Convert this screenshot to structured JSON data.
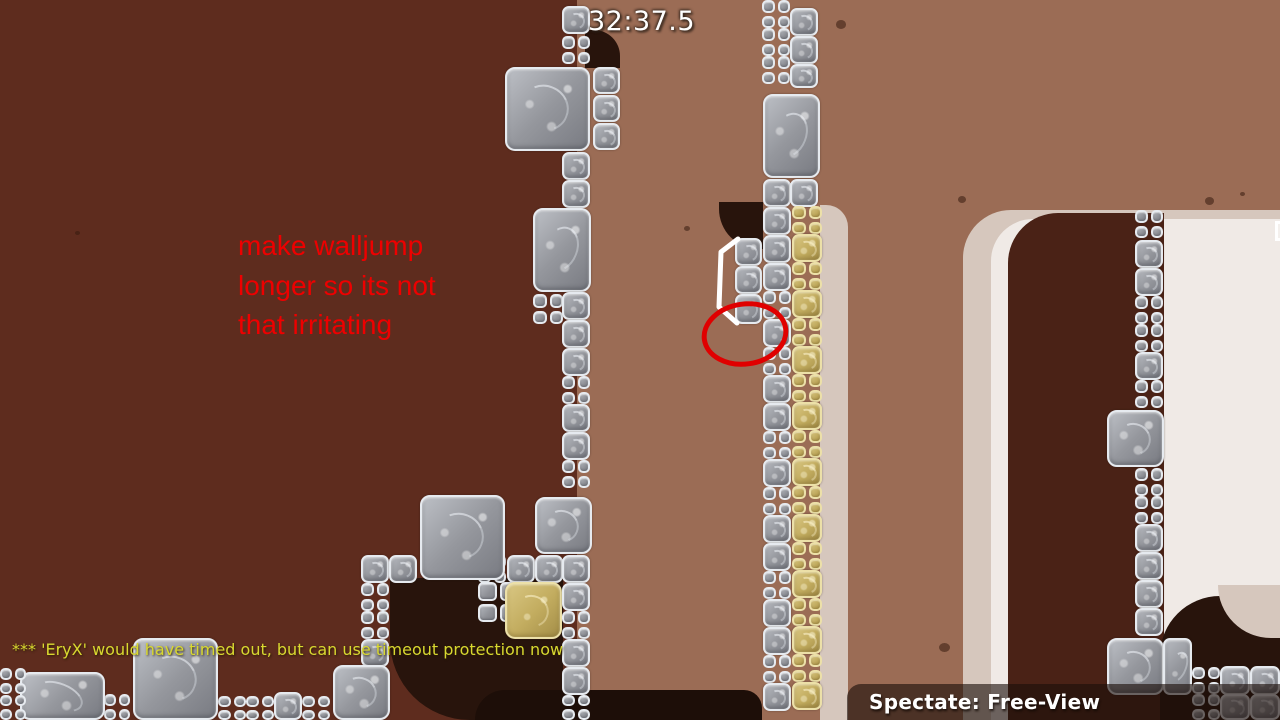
{
  "hud": {
    "timer": "32:37.5",
    "console_message": "*** 'EryX' would have timed out, but can use timeout protection now",
    "spectate_label": "Spectate: Free-View"
  },
  "annotations": {
    "note_lines": [
      "make walljump",
      "longer so its not",
      "that irritating"
    ],
    "circle": {
      "cx": 745,
      "cy": 334,
      "rx": 41,
      "ry": 30,
      "stroke_width": 5
    },
    "path_points": "738,239 721,252 719,307 737,323"
  },
  "colors": {
    "bg_mid": "#9b6c55",
    "bg_left": "#5e2c1e",
    "cave": "#28140c",
    "beige": "#d6c7bd",
    "cream": "#f0eae6",
    "inner_maroon": "#4a2216",
    "tg_border": "#e6eaef",
    "td_border": "#ece0a8",
    "note": "#ee0000",
    "console": "#d8d830",
    "hud_text": "#ffffff",
    "panel": "rgba(28,14,9,0.62)"
  },
  "map": {
    "tiles": [
      [
        "m",
        "g",
        562,
        6,
        28,
        28
      ],
      [
        "q",
        "g",
        562,
        36,
        28,
        28
      ],
      [
        "b",
        "g",
        505,
        67,
        85,
        84
      ],
      [
        "m",
        "g",
        593,
        67,
        27,
        27
      ],
      [
        "m",
        "g",
        593,
        95,
        27,
        27
      ],
      [
        "m",
        "g",
        593,
        123,
        27,
        27
      ],
      [
        "m",
        "g",
        562,
        152,
        28,
        28
      ],
      [
        "m",
        "g",
        562,
        180,
        28,
        28
      ],
      [
        "b",
        "g",
        533,
        208,
        58,
        84
      ],
      [
        "q",
        "g",
        533,
        294,
        30,
        30
      ],
      [
        "m",
        "g",
        562,
        292,
        28,
        28
      ],
      [
        "m",
        "g",
        562,
        320,
        28,
        28
      ],
      [
        "m",
        "g",
        562,
        348,
        28,
        28
      ],
      [
        "q",
        "g",
        562,
        376,
        28,
        28
      ],
      [
        "m",
        "g",
        562,
        404,
        28,
        28
      ],
      [
        "m",
        "g",
        562,
        432,
        28,
        28
      ],
      [
        "q",
        "g",
        562,
        460,
        28,
        28
      ],
      [
        "b",
        "g",
        535,
        497,
        57,
        57
      ],
      [
        "q",
        "g",
        478,
        555,
        28,
        28
      ],
      [
        "m",
        "g",
        507,
        555,
        28,
        28
      ],
      [
        "m",
        "g",
        535,
        555,
        28,
        28
      ],
      [
        "m",
        "g",
        562,
        555,
        28,
        28
      ],
      [
        "q",
        "g",
        478,
        582,
        40,
        40
      ],
      [
        "b",
        "d",
        505,
        582,
        57,
        57
      ],
      [
        "m",
        "g",
        562,
        583,
        28,
        28
      ],
      [
        "q",
        "g",
        562,
        611,
        28,
        28
      ],
      [
        "m",
        "g",
        562,
        639,
        28,
        28
      ],
      [
        "m",
        "g",
        562,
        667,
        28,
        28
      ],
      [
        "q",
        "g",
        562,
        695,
        28,
        25
      ],
      [
        "m",
        "g",
        361,
        555,
        28,
        28
      ],
      [
        "q",
        "g",
        361,
        583,
        28,
        28
      ],
      [
        "q",
        "g",
        361,
        611,
        28,
        28
      ],
      [
        "m",
        "g",
        361,
        639,
        28,
        28
      ],
      [
        "m",
        "g",
        389,
        555,
        28,
        28
      ],
      [
        "b",
        "g",
        420,
        495,
        85,
        85
      ],
      [
        "b",
        "g",
        333,
        665,
        57,
        55
      ],
      [
        "q",
        "g",
        302,
        696,
        28,
        24
      ],
      [
        "m",
        "g",
        274,
        692,
        28,
        28
      ],
      [
        "q",
        "g",
        246,
        696,
        28,
        24
      ],
      [
        "q",
        "g",
        218,
        696,
        28,
        24
      ],
      [
        "b",
        "g",
        133,
        638,
        85,
        82
      ],
      [
        "q",
        "g",
        104,
        694,
        26,
        26
      ],
      [
        "b",
        "g",
        20,
        672,
        85,
        48
      ],
      [
        "q",
        "g",
        0,
        668,
        26,
        26
      ],
      [
        "q",
        "g",
        0,
        695,
        26,
        25
      ],
      [
        "q",
        "g",
        762,
        0,
        28,
        28
      ],
      [
        "q",
        "g",
        762,
        28,
        28,
        28
      ],
      [
        "q",
        "g",
        762,
        56,
        28,
        28
      ],
      [
        "m",
        "g",
        790,
        8,
        28,
        28
      ],
      [
        "m",
        "g",
        790,
        36,
        28,
        28
      ],
      [
        "m",
        "g",
        790,
        64,
        28,
        24
      ],
      [
        "b",
        "g",
        763,
        94,
        57,
        84
      ],
      [
        "m",
        "g",
        763,
        179,
        28,
        28
      ],
      [
        "m",
        "g",
        790,
        179,
        28,
        28
      ],
      [
        "m",
        "g",
        763,
        207,
        28,
        28
      ],
      [
        "m",
        "g",
        735,
        238,
        27,
        28
      ],
      [
        "m",
        "g",
        735,
        266,
        27,
        28
      ],
      [
        "m",
        "g",
        735,
        294,
        27,
        30
      ],
      [
        "m",
        "g",
        763,
        235,
        28,
        28
      ],
      [
        "m",
        "g",
        763,
        263,
        28,
        28
      ],
      [
        "q",
        "g",
        763,
        291,
        28,
        28
      ],
      [
        "m",
        "g",
        763,
        319,
        28,
        28
      ],
      [
        "q",
        "g",
        763,
        347,
        28,
        28
      ],
      [
        "m",
        "g",
        763,
        375,
        28,
        28
      ],
      [
        "m",
        "g",
        763,
        403,
        28,
        28
      ],
      [
        "q",
        "g",
        763,
        431,
        28,
        28
      ],
      [
        "m",
        "g",
        763,
        459,
        28,
        28
      ],
      [
        "q",
        "g",
        763,
        487,
        28,
        28
      ],
      [
        "m",
        "g",
        763,
        515,
        28,
        28
      ],
      [
        "m",
        "g",
        763,
        543,
        28,
        28
      ],
      [
        "q",
        "g",
        763,
        571,
        28,
        28
      ],
      [
        "m",
        "g",
        763,
        599,
        28,
        28
      ],
      [
        "m",
        "g",
        763,
        627,
        28,
        28
      ],
      [
        "q",
        "g",
        763,
        655,
        28,
        28
      ],
      [
        "m",
        "g",
        763,
        683,
        28,
        28
      ],
      [
        "q",
        "d",
        792,
        206,
        30,
        28
      ],
      [
        "m",
        "d",
        792,
        234,
        30,
        28
      ],
      [
        "q",
        "d",
        792,
        262,
        30,
        28
      ],
      [
        "m",
        "d",
        792,
        290,
        30,
        28
      ],
      [
        "q",
        "d",
        792,
        318,
        30,
        28
      ],
      [
        "m",
        "d",
        792,
        346,
        30,
        28
      ],
      [
        "q",
        "d",
        792,
        374,
        30,
        28
      ],
      [
        "m",
        "d",
        792,
        402,
        30,
        28
      ],
      [
        "q",
        "d",
        792,
        430,
        30,
        28
      ],
      [
        "m",
        "d",
        792,
        458,
        30,
        28
      ],
      [
        "q",
        "d",
        792,
        486,
        30,
        28
      ],
      [
        "m",
        "d",
        792,
        514,
        30,
        28
      ],
      [
        "q",
        "d",
        792,
        542,
        30,
        28
      ],
      [
        "m",
        "d",
        792,
        570,
        30,
        28
      ],
      [
        "q",
        "d",
        792,
        598,
        30,
        28
      ],
      [
        "m",
        "d",
        792,
        626,
        30,
        28
      ],
      [
        "q",
        "d",
        792,
        654,
        30,
        28
      ],
      [
        "m",
        "d",
        792,
        682,
        30,
        28
      ],
      [
        "q",
        "g",
        1135,
        210,
        28,
        28
      ],
      [
        "m",
        "g",
        1135,
        240,
        28,
        28
      ],
      [
        "m",
        "g",
        1135,
        268,
        28,
        28
      ],
      [
        "q",
        "g",
        1135,
        296,
        28,
        28
      ],
      [
        "q",
        "g",
        1135,
        324,
        28,
        28
      ],
      [
        "m",
        "g",
        1135,
        352,
        28,
        28
      ],
      [
        "q",
        "g",
        1135,
        380,
        28,
        28
      ],
      [
        "b",
        "g",
        1107,
        410,
        57,
        57
      ],
      [
        "q",
        "g",
        1135,
        468,
        28,
        28
      ],
      [
        "q",
        "g",
        1135,
        496,
        28,
        28
      ],
      [
        "m",
        "g",
        1135,
        524,
        28,
        28
      ],
      [
        "m",
        "g",
        1135,
        552,
        28,
        28
      ],
      [
        "m",
        "g",
        1135,
        580,
        28,
        28
      ],
      [
        "m",
        "g",
        1135,
        608,
        28,
        28
      ],
      [
        "b",
        "g",
        1107,
        638,
        57,
        57
      ],
      [
        "m",
        "g",
        1163,
        638,
        29,
        57
      ],
      [
        "q",
        "g",
        1192,
        667,
        28,
        27
      ],
      [
        "m",
        "g",
        1220,
        666,
        30,
        29
      ],
      [
        "m",
        "g",
        1250,
        666,
        30,
        29
      ],
      [
        "q",
        "g",
        1192,
        694,
        28,
        26
      ],
      [
        "m",
        "g",
        1220,
        694,
        30,
        26
      ],
      [
        "m",
        "g",
        1250,
        694,
        30,
        26
      ]
    ],
    "spots": [
      [
        836,
        20,
        10
      ],
      [
        958,
        196,
        8
      ],
      [
        684,
        226,
        6
      ],
      [
        939,
        643,
        11
      ],
      [
        75,
        231,
        5
      ],
      [
        1205,
        197,
        9
      ],
      [
        1240,
        192,
        5
      ]
    ]
  }
}
